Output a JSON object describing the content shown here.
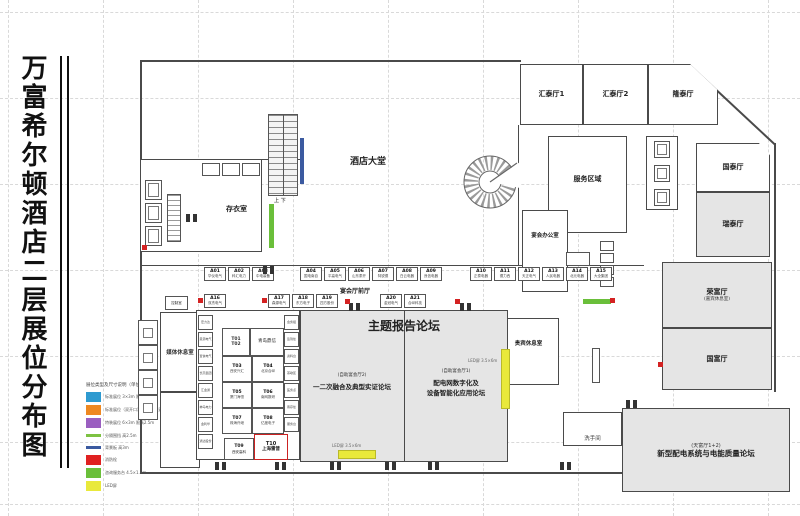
{
  "title": "万富希尔顿酒店二层展位分布图",
  "legend": {
    "header": "展位类型及尺寸说明（单位：m）",
    "items": [
      {
        "shape": "box",
        "color": "#2e9ad0",
        "label": "标准展位 3×3m 限高2.5m"
      },
      {
        "shape": "box",
        "color": "#ee8821",
        "label": "标准展位（双开口）3×3m 限高2.5m"
      },
      {
        "shape": "box",
        "color": "#9a5fc0",
        "label": "特装展位 6×3m 限高2.5m"
      },
      {
        "shape": "line",
        "color": "#7dc242",
        "label": "分隔围挡 高2.5m"
      },
      {
        "shape": "line",
        "color": "#3b5aa0",
        "label": "背景板 高3m"
      },
      {
        "shape": "box",
        "color": "#e02121",
        "label": "消防栓"
      },
      {
        "shape": "box",
        "color": "#6abf3a",
        "label": "咨询服务台 4.5×1.2m"
      },
      {
        "shape": "box",
        "color": "#e9e93b",
        "label": "LED屏"
      }
    ]
  },
  "rooms": {
    "huitai1": "汇泰厅1",
    "huitai2": "汇泰厅2",
    "longtai": "隆泰厅",
    "guotai": "国泰厅",
    "ruitai": "瑞泰厅",
    "rongfu": "荣富厅",
    "rongfu_sub": "(嘉宾休息室)",
    "guofu": "国富厅",
    "lobby": "酒店大堂",
    "cloakroom": "存衣室",
    "service_area": "服务区域",
    "banquet_office": "宴会办公室",
    "vip_lounge": "贵宾休息室",
    "restroom": "洗手间",
    "media_lounge": "媒体休息室",
    "control_room": "控制室",
    "foyer": "宴会厅前厅",
    "escalator_mark": "上 下"
  },
  "forums": {
    "main_title": "主题报告论坛",
    "hall2_sub": "(自助宴会厅2)",
    "hall2_title": "一二次融合及典型实证论坛",
    "hall1_sub": "(自助宴会厅1)",
    "hall1_title1": "配电网数字化及",
    "hall1_title2": "设备智能化应用论坛",
    "tianfu_sub": "(天富厅1+2)",
    "tianfu_title": "新型配电系统与电能质量论坛",
    "led_h_label": "LED屏 3.5×6m",
    "led_v_label": "LED屏 3.5×6m"
  },
  "t_block": {
    "t1": "T01",
    "t2": "T02",
    "t12_name": "青岛鼎信",
    "pairs": [
      {
        "code": "T03",
        "name": "西安兴汇"
      },
      {
        "code": "T04",
        "name": "北京合纵"
      },
      {
        "code": "T05",
        "name": "厦门海恒"
      },
      {
        "code": "T06",
        "name": "南网数研"
      },
      {
        "code": "T07",
        "name": "珠海许继"
      },
      {
        "code": "T08",
        "name": "亿度电子"
      }
    ],
    "t09": {
      "code": "T09",
      "name": "西安高科"
    },
    "t10": {
      "code": "T10",
      "name": "上海雷普"
    }
  },
  "corridor_booths": {
    "top_g1": [
      {
        "code": "A01",
        "name": "华仪电气"
      },
      {
        "code": "A02",
        "name": "科汇电力"
      },
      {
        "code": "A03",
        "name": "中电装备"
      }
    ],
    "top_g2": [
      {
        "code": "A04",
        "name": "国电南自"
      },
      {
        "code": "A05",
        "name": "平高电气"
      },
      {
        "code": "A06",
        "name": "山东泰开"
      },
      {
        "code": "A07",
        "name": "特锐德"
      },
      {
        "code": "A08",
        "name": "白云电器"
      },
      {
        "code": "A09",
        "name": "良信电器"
      }
    ],
    "top_g3": [
      {
        "code": "A10",
        "name": "正泰电器"
      },
      {
        "code": "A11",
        "name": "德力西"
      },
      {
        "code": "A12",
        "name": "天正电气"
      },
      {
        "code": "A13",
        "name": "人民电器"
      },
      {
        "code": "A14",
        "name": "北元电器"
      },
      {
        "code": "A15",
        "name": "大全集团"
      }
    ],
    "bottom_g1": [
      {
        "code": "A16",
        "name": "双杰电气"
      }
    ],
    "bottom_g2": [
      {
        "code": "A17",
        "name": "森源电气"
      },
      {
        "code": "A18",
        "name": "东方电子"
      },
      {
        "code": "A19",
        "name": "四方股份"
      }
    ],
    "bottom_g3": [
      {
        "code": "A20",
        "name": "金冠电气"
      },
      {
        "code": "A21",
        "name": "合纵科技"
      }
    ],
    "left_strip": [
      {
        "name": "宏力达"
      },
      {
        "name": "思源电气"
      },
      {
        "name": "置信电气"
      },
      {
        "name": "长高集团"
      },
      {
        "name": "汇金通"
      },
      {
        "name": "神马电力"
      },
      {
        "name": "金利华"
      },
      {
        "name": "通达股份"
      }
    ],
    "right_strip": [
      {
        "name": "会务组"
      },
      {
        "name": "签到处"
      },
      {
        "name": "资料台"
      },
      {
        "name": "茶歇区"
      },
      {
        "name": "医务点"
      },
      {
        "name": "寄存处"
      },
      {
        "name": "服务台"
      }
    ]
  }
}
